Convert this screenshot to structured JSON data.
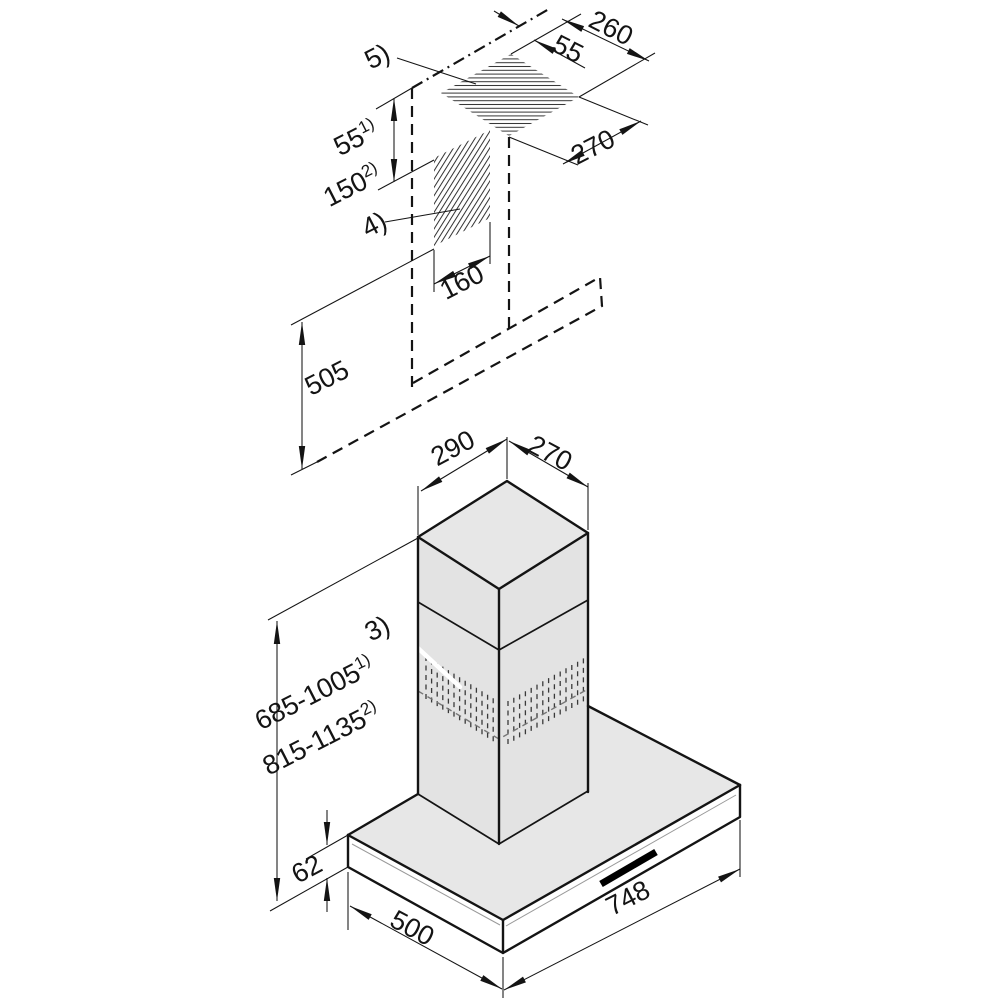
{
  "page": {
    "background": "#ffffff",
    "line_color": "#141414",
    "body_fill": "#e7e7e7",
    "side_fill": "#e3e3e3"
  },
  "callouts": {
    "ceiling_cutout": "5)",
    "wall_cutout": "4)",
    "vent_slots": "3)"
  },
  "dims": {
    "ceiling_cutout_width": "260",
    "ceiling_hole_offset": "55",
    "ceiling_cutout_depth": "270",
    "ceiling_clearance_1": {
      "value": "55",
      "sup": "1)"
    },
    "ceiling_clearance_2": {
      "value": "150",
      "sup": "2)"
    },
    "wall_duct_width": "160",
    "wall_duct_height": "505",
    "chimney_width": "290",
    "chimney_depth": "270",
    "height_range_1": {
      "value": "685-1005",
      "sup": "1)"
    },
    "height_range_2": {
      "value": "815-1135",
      "sup": "2)"
    },
    "canopy_thickness": "62",
    "canopy_depth": "500",
    "canopy_width": "748"
  }
}
